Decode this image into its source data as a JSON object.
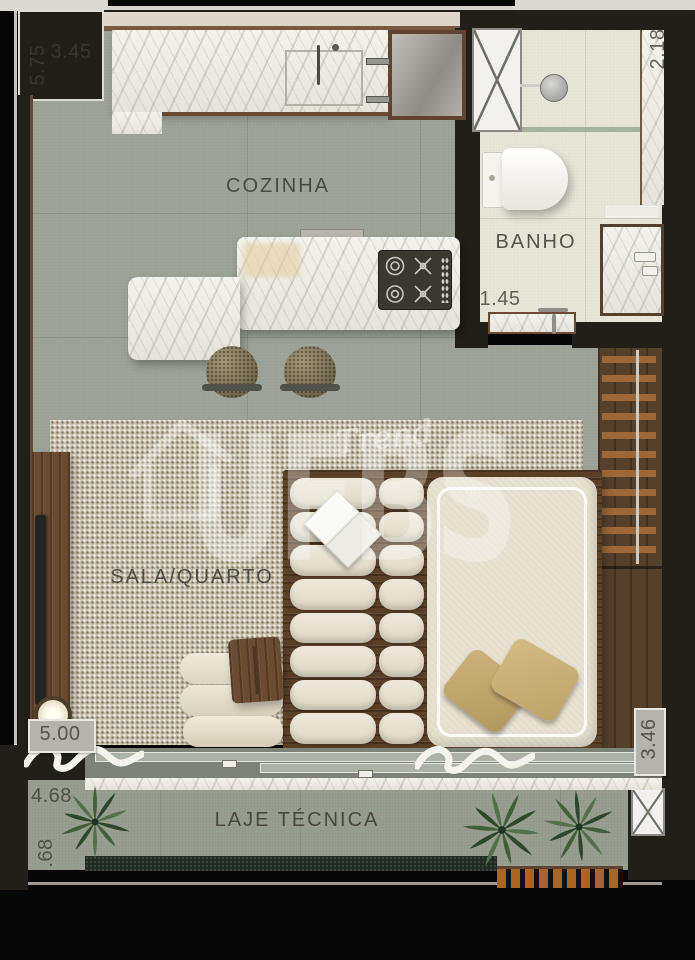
{
  "rooms": {
    "cozinha": {
      "label": "COZINHA"
    },
    "banho": {
      "label": "BANHO"
    },
    "sala_quarto": {
      "label": "SALA/QUARTO"
    },
    "laje_tecnica": {
      "label": "LAJE TÉCNICA"
    }
  },
  "dimensions": {
    "kitchen_depth": "5.75",
    "kitchen_width": "3.45",
    "banho_depth": "2.18",
    "banho_width": "1.45",
    "sala_depth": "5.00",
    "bed_wall": "3.46",
    "balcony_width": "4.68",
    "balcony_depth": ".68"
  },
  "watermark": {
    "brand": "UFBS",
    "registered_mark": "®",
    "signature": "Trend"
  },
  "colors": {
    "wall": "#221e18",
    "kitchen_floor": "#a0a69a",
    "bathroom_floor": "#eae6da",
    "balcony_floor": "#99a092",
    "rug": "#c9c1ae",
    "wood": "#6a4a32",
    "marble": "#f1efe9",
    "upholstery": "#e9e3d3",
    "pillow": "#c4a96f",
    "plant_green": "#3c5a36",
    "label_text": "#3b3a33",
    "watermark_white": "#ffffff"
  }
}
